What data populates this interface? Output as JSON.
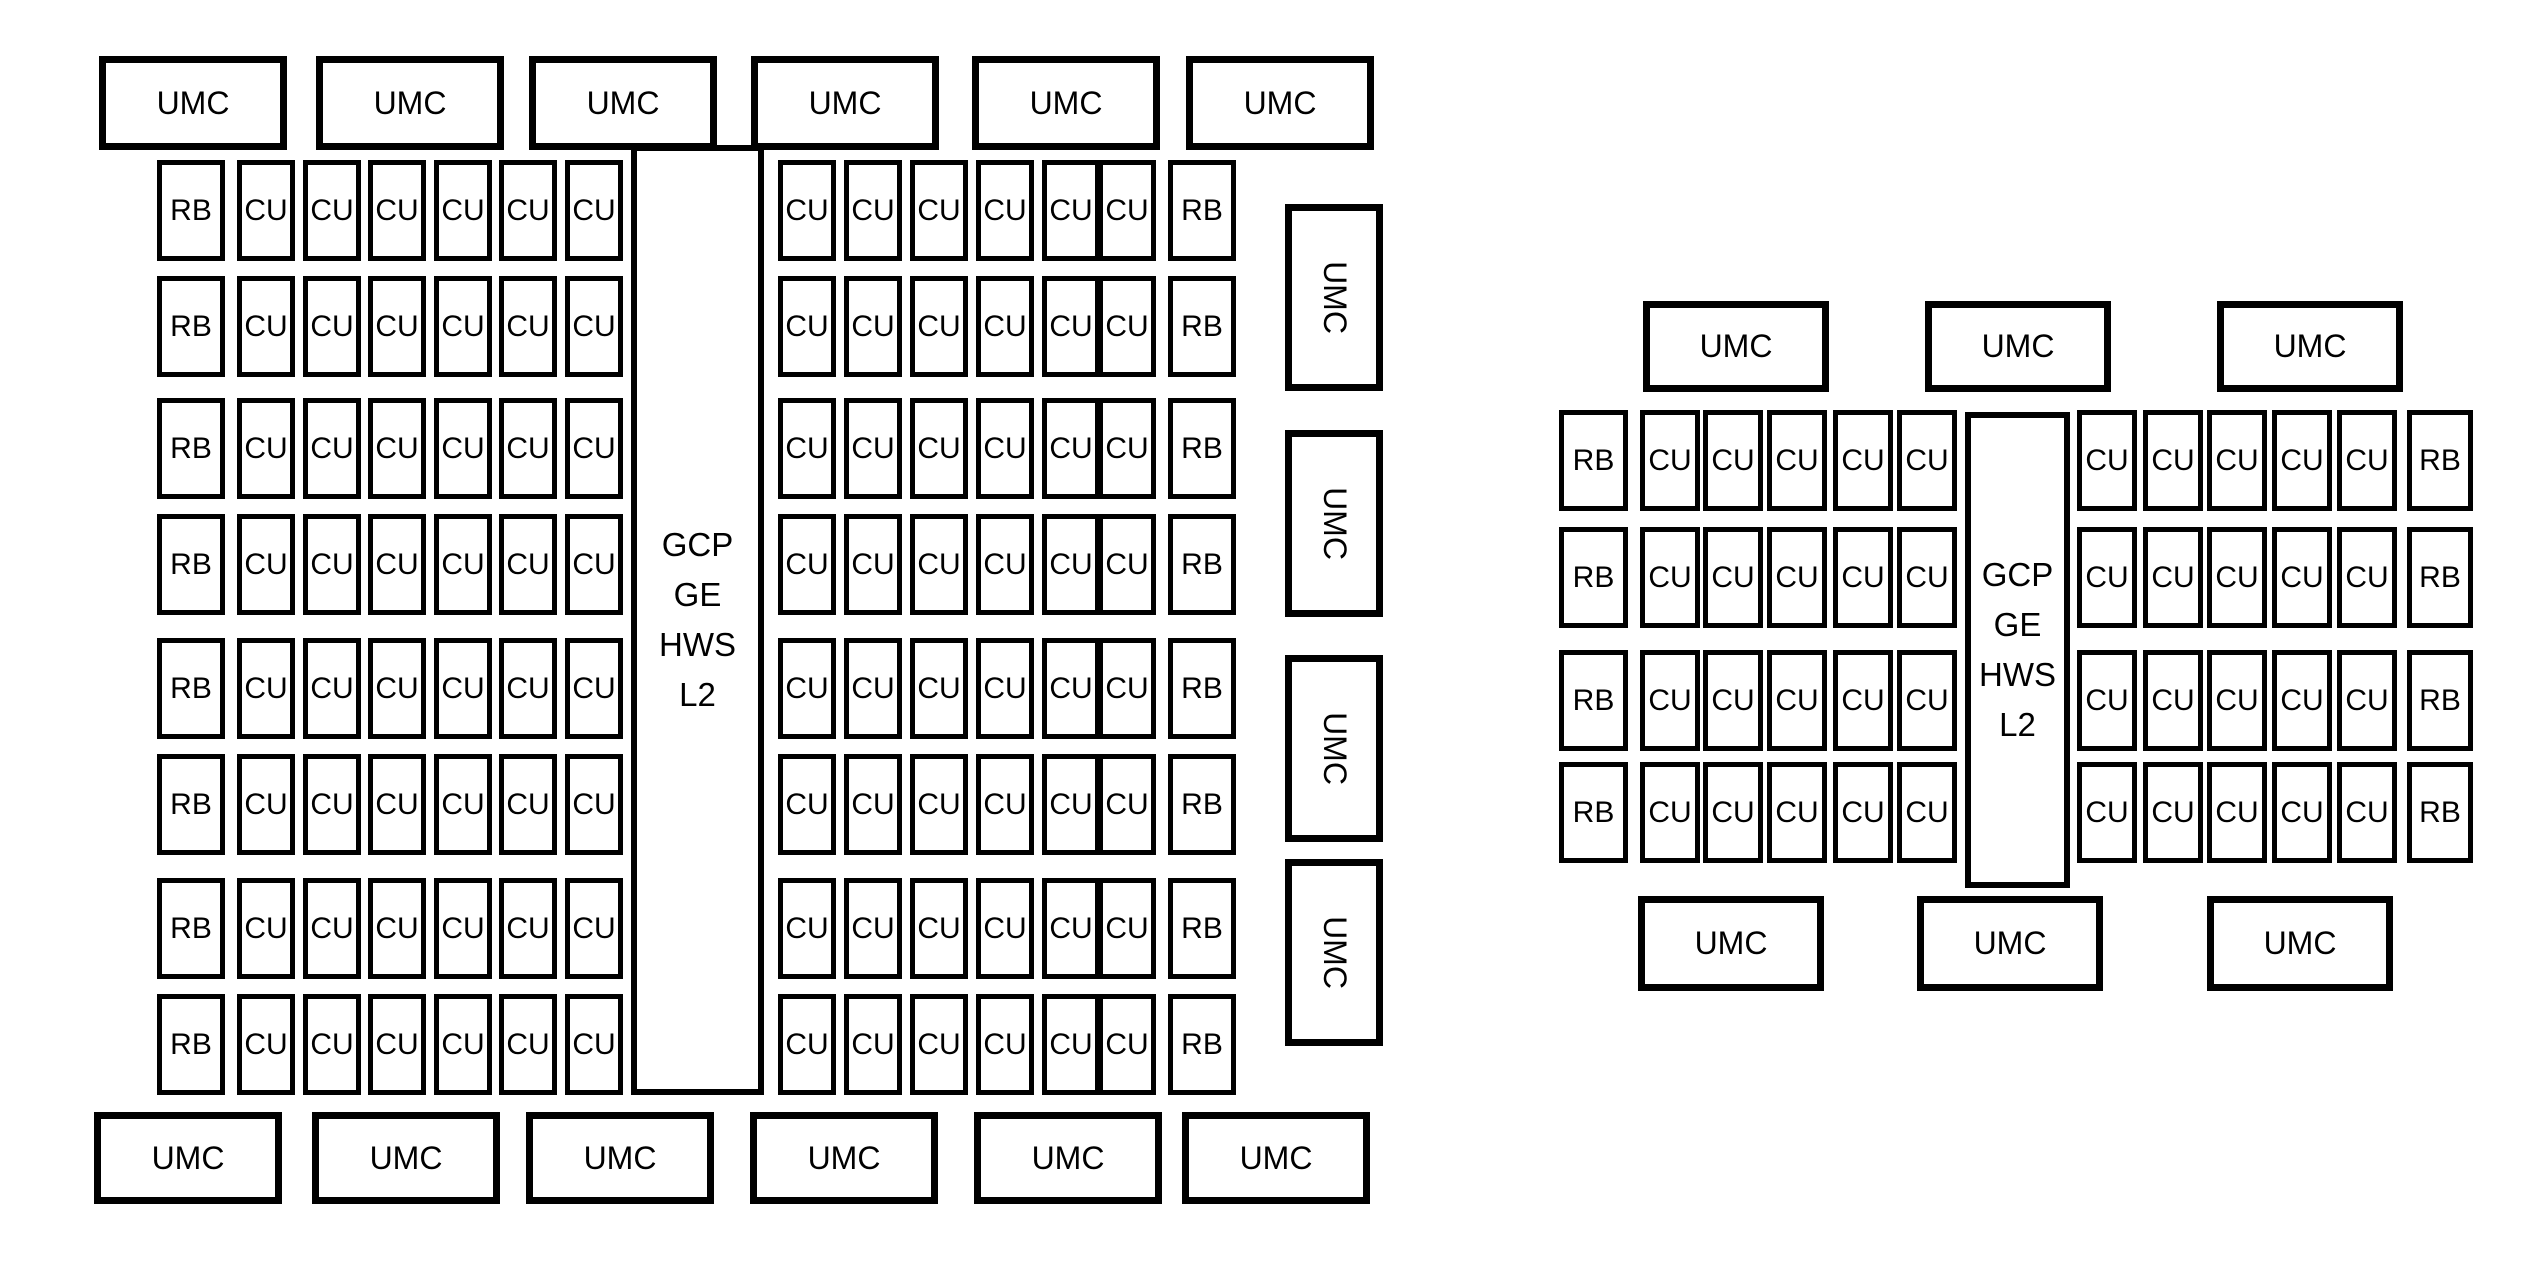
{
  "page": {
    "background": "#ffffff",
    "border_color": "#000000",
    "text_color": "#000000"
  },
  "diagrams": [
    {
      "id": "large-die",
      "labels": {
        "umc": "UMC",
        "rb": "RB",
        "cu": "CU"
      },
      "center_lines": [
        "GCP",
        "GE",
        "HWS",
        "L2"
      ],
      "structure": {
        "top_umc_count": 6,
        "bottom_umc_count": 6,
        "side_umc_count": 4,
        "row_count": 8,
        "cus_per_half_row": 6,
        "rbs_per_row": 2
      },
      "geom": {
        "top_umcs": {
          "y": 56,
          "h": 94,
          "w": 188,
          "xs": [
            99,
            316,
            529,
            751,
            972,
            1186
          ]
        },
        "bottom_umcs": {
          "y": 1112,
          "h": 92,
          "w": 188,
          "xs": [
            94,
            312,
            526,
            750,
            974,
            1182
          ]
        },
        "side_umcs": {
          "x": 1285,
          "w": 98,
          "h": 187,
          "ys": [
            204,
            430,
            655,
            859
          ]
        },
        "rows": {
          "h": 101,
          "ys": [
            160,
            276,
            398,
            514,
            638,
            754,
            878,
            994
          ]
        },
        "left_rb": {
          "x": 157,
          "w": 68
        },
        "left_cus": {
          "w": 58,
          "xs": [
            237,
            303,
            368,
            434,
            499,
            565
          ]
        },
        "center": {
          "x": 631,
          "y": 145,
          "w": 133,
          "h": 950
        },
        "right_cus": {
          "w": 58,
          "xs": [
            778,
            844,
            910,
            976,
            1042,
            1098
          ]
        },
        "right_rb": {
          "x": 1168,
          "w": 68
        }
      }
    },
    {
      "id": "small-die",
      "labels": {
        "umc": "UMC",
        "rb": "RB",
        "cu": "CU"
      },
      "center_lines": [
        "GCP",
        "GE",
        "HWS",
        "L2"
      ],
      "structure": {
        "top_umc_count": 3,
        "bottom_umc_count": 3,
        "side_umc_count": 0,
        "row_count": 4,
        "cus_per_half_row": 5,
        "rbs_per_row": 2
      },
      "geom": {
        "top_umcs": {
          "y": 301,
          "h": 91,
          "w": 186,
          "xs": [
            1643,
            1925,
            2217
          ]
        },
        "bottom_umcs": {
          "y": 896,
          "h": 95,
          "w": 186,
          "xs": [
            1638,
            1917,
            2207
          ]
        },
        "side_umcs": {
          "x": 0,
          "w": 0,
          "h": 0,
          "ys": []
        },
        "rows": {
          "h": 101,
          "ys": [
            410,
            527,
            650,
            762
          ]
        },
        "left_rb": {
          "x": 1559,
          "w": 69
        },
        "left_cus": {
          "w": 60,
          "xs": [
            1640,
            1703,
            1767,
            1833,
            1897
          ]
        },
        "center": {
          "x": 1965,
          "y": 412,
          "w": 105,
          "h": 476
        },
        "right_cus": {
          "w": 60,
          "xs": [
            2077,
            2143,
            2207,
            2272,
            2337
          ]
        },
        "right_rb": {
          "x": 2407,
          "w": 66
        }
      }
    }
  ]
}
